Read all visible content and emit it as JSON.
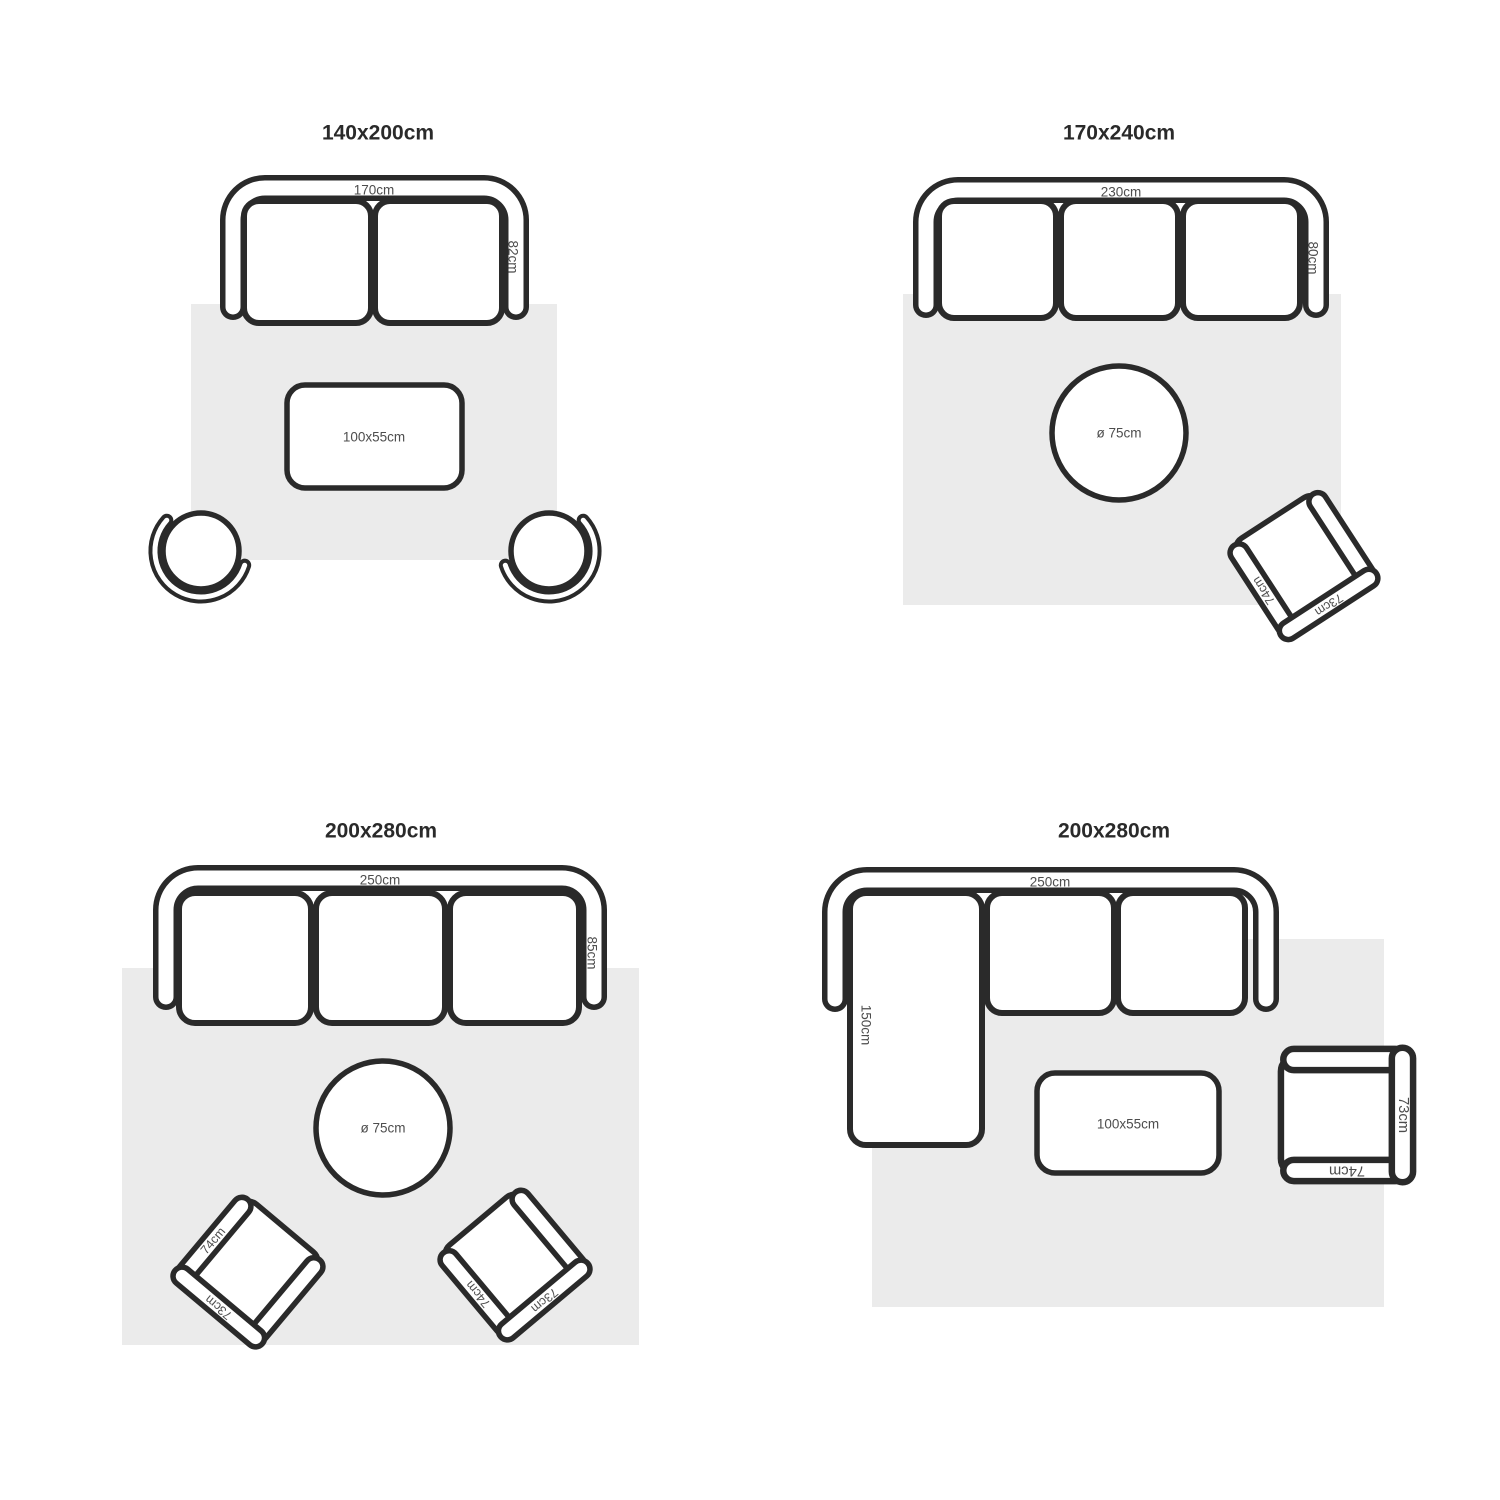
{
  "colors": {
    "line": "#2a2a2a",
    "rug": "#ebebeb",
    "label": "#4d4d4d",
    "title": "#2a2a2a"
  },
  "q1": {
    "title": "140x200cm",
    "sofa_width_label": "170cm",
    "sofa_depth_label": "82cm",
    "coffee_table_label": "100x55cm"
  },
  "q2": {
    "title": "170x240cm",
    "sofa_width_label": "230cm",
    "sofa_depth_label": "80cm",
    "round_table_label": "ø 75cm",
    "armchair": {
      "arm_label": "74cm",
      "back_label": "73cm"
    }
  },
  "q3": {
    "title": "200x280cm",
    "sofa_width_label": "250cm",
    "sofa_depth_label": "85cm",
    "round_table_label": "ø 75cm",
    "armchair_left": {
      "arm_label": "74cm",
      "back_label": "73cm"
    },
    "armchair_right": {
      "arm_label": "74cm",
      "back_label": "73cm"
    }
  },
  "q4": {
    "title": "200x280cm",
    "sofa_width_label": "250cm",
    "chaise_length_label": "150cm",
    "coffee_table_label": "100x55cm",
    "armchair": {
      "arm_label": "74cm",
      "back_label": "73cm"
    }
  }
}
